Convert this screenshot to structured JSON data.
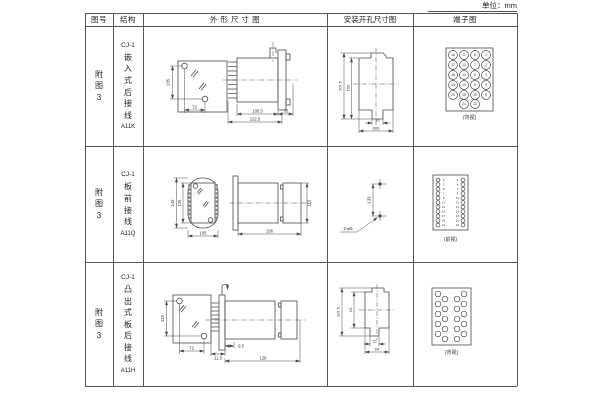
{
  "page": {
    "unit_label": "单位：mm"
  },
  "header": {
    "fig": "图号",
    "structure": "结构",
    "outline": "外 形 尺 寸 图",
    "mount": "安装开孔尺寸图",
    "terminal": "端子图"
  },
  "rows": [
    {
      "fig_no": "附图3",
      "model": "CJ-1",
      "structure": "嵌入式后接线",
      "code": "A11K",
      "view_label": "(背视)",
      "dims": {
        "front_height": "135",
        "front_width": "72",
        "body_length": "100.5",
        "total_length": "122.5",
        "rear_length": "35",
        "cutout_height_outer": "107.5",
        "cutout_height_inner": "105",
        "slot_width": "16",
        "cutout_width": "(66)"
      }
    },
    {
      "fig_no": "附图3",
      "model": "CJ-1",
      "structure": "板前接线",
      "code": "A11Q",
      "view_label": "(前视)",
      "dims": {
        "front_height_outer": "145",
        "front_height_inner": "125",
        "front_width": "105",
        "body_length": "156",
        "rear_height": "110",
        "hole_spacing": "133",
        "hole_note": "2-φ6"
      }
    },
    {
      "fig_no": "附图3",
      "model": "CJ-1",
      "structure": "凸出式板后接线",
      "code": "A11H",
      "view_label": "(背视)",
      "dims": {
        "front_height": "115",
        "front_width": "72",
        "pin_dim": "11.5",
        "offset_dim": "9.5",
        "body_length": "126",
        "cutout_height_outer": "107.5",
        "cutout_height_inner": "94",
        "slot_width": "16",
        "cutout_width": "64"
      }
    }
  ],
  "terminal_diagrams": [
    {
      "r": 4.5,
      "font": 3.4,
      "circles": [
        [
          40,
          29,
          "16"
        ],
        [
          51,
          29,
          "11"
        ],
        [
          62,
          29,
          "6"
        ],
        [
          73,
          29,
          "1"
        ],
        [
          40,
          39,
          "17"
        ],
        [
          51,
          39,
          "12"
        ],
        [
          62,
          39,
          "7"
        ],
        [
          73,
          39,
          "2"
        ],
        [
          40,
          49,
          "18"
        ],
        [
          51,
          49,
          "13"
        ],
        [
          62,
          49,
          "8"
        ],
        [
          73,
          49,
          "3"
        ],
        [
          40,
          59,
          "19"
        ],
        [
          51,
          59,
          "14"
        ],
        [
          62,
          59,
          "9"
        ],
        [
          73,
          59,
          "4"
        ],
        [
          40,
          69,
          "20"
        ],
        [
          51,
          69,
          "15"
        ],
        [
          62,
          69,
          "10"
        ],
        [
          73,
          69,
          "5"
        ],
        [
          51,
          78,
          "21"
        ],
        [
          62,
          78,
          "22"
        ]
      ]
    },
    {
      "r": 1.9,
      "font": 2.9,
      "circles": [
        [
          25,
          34
        ],
        [
          25,
          38.5
        ],
        [
          25,
          43
        ],
        [
          25,
          47.5
        ],
        [
          25,
          52
        ],
        [
          25,
          56.5
        ],
        [
          25,
          61
        ],
        [
          25,
          65.5
        ],
        [
          25,
          70
        ],
        [
          25,
          74.5
        ],
        [
          25,
          79
        ],
        [
          50,
          34
        ],
        [
          50,
          38.5
        ],
        [
          50,
          43
        ],
        [
          50,
          47.5
        ],
        [
          50,
          52
        ],
        [
          50,
          56.5
        ],
        [
          50,
          61
        ],
        [
          50,
          65.5
        ],
        [
          50,
          70
        ],
        [
          50,
          74.5
        ],
        [
          50,
          79
        ]
      ],
      "texts": [
        [
          30.5,
          35.1,
          "1"
        ],
        [
          30.5,
          39.6,
          "3"
        ],
        [
          30.5,
          44.1,
          "5"
        ],
        [
          30.5,
          48.6,
          "7"
        ],
        [
          30.5,
          53.1,
          "9"
        ],
        [
          30.5,
          57.6,
          "11"
        ],
        [
          30.5,
          62.1,
          "13"
        ],
        [
          30.5,
          66.6,
          "15"
        ],
        [
          30.5,
          71.1,
          "17"
        ],
        [
          30.5,
          75.6,
          "19"
        ],
        [
          30.5,
          80.1,
          "21"
        ],
        [
          44.5,
          35.1,
          "2"
        ],
        [
          44.5,
          39.6,
          "4"
        ],
        [
          44.5,
          44.1,
          "6"
        ],
        [
          44.5,
          48.6,
          "8"
        ],
        [
          44.5,
          53.1,
          "10"
        ],
        [
          44.5,
          57.6,
          "12"
        ],
        [
          44.5,
          62.1,
          "14"
        ],
        [
          44.5,
          66.6,
          "16"
        ],
        [
          44.5,
          71.1,
          "18"
        ],
        [
          44.5,
          75.6,
          "20"
        ],
        [
          44.5,
          80.1,
          "22"
        ]
      ]
    },
    {
      "r": 2.8,
      "font": 0,
      "circles": [
        [
          25,
          32
        ],
        [
          25,
          42
        ],
        [
          25,
          52
        ],
        [
          25,
          62
        ],
        [
          25,
          72
        ],
        [
          32,
          37
        ],
        [
          32,
          47
        ],
        [
          32,
          57
        ],
        [
          32,
          67
        ],
        [
          32,
          77
        ],
        [
          44,
          37
        ],
        [
          44,
          47
        ],
        [
          44,
          57
        ],
        [
          44,
          67
        ],
        [
          44,
          77
        ],
        [
          51,
          32
        ],
        [
          51,
          42
        ],
        [
          51,
          52
        ],
        [
          51,
          62
        ],
        [
          51,
          72
        ]
      ]
    }
  ]
}
